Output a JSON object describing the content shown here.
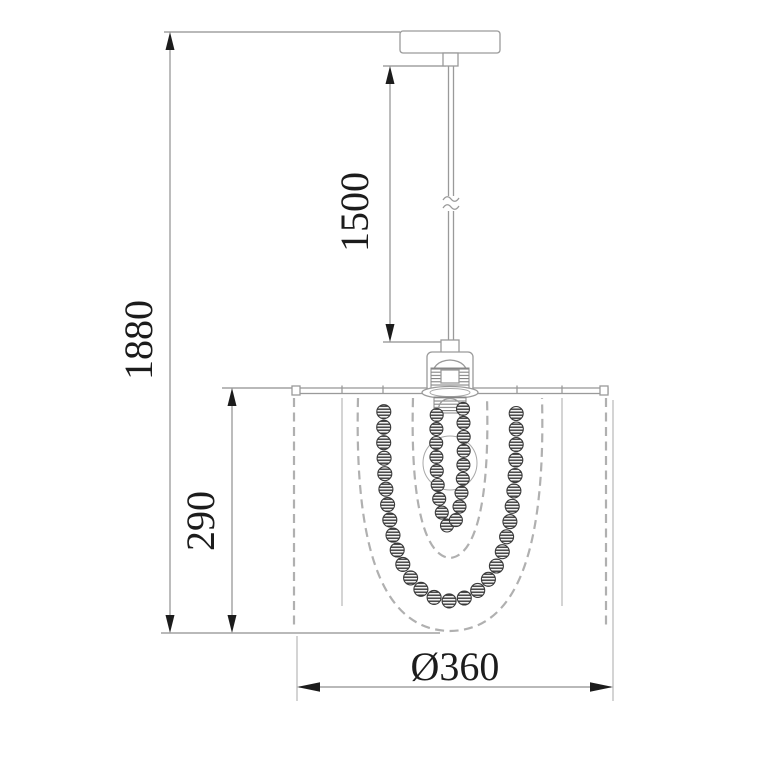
{
  "drawing": {
    "subject": "pendant-lamp-dimension-drawing",
    "colors": {
      "background": "#ffffff",
      "thin_line": "#9a9a9a",
      "hidden_dash": "#b0b0b0",
      "dimension_ink": "#1c1c1c"
    },
    "dimensions": {
      "overall_height": "1880",
      "suspension_length": "1500",
      "shade_height": "290",
      "shade_diameter": "Ø360"
    }
  }
}
